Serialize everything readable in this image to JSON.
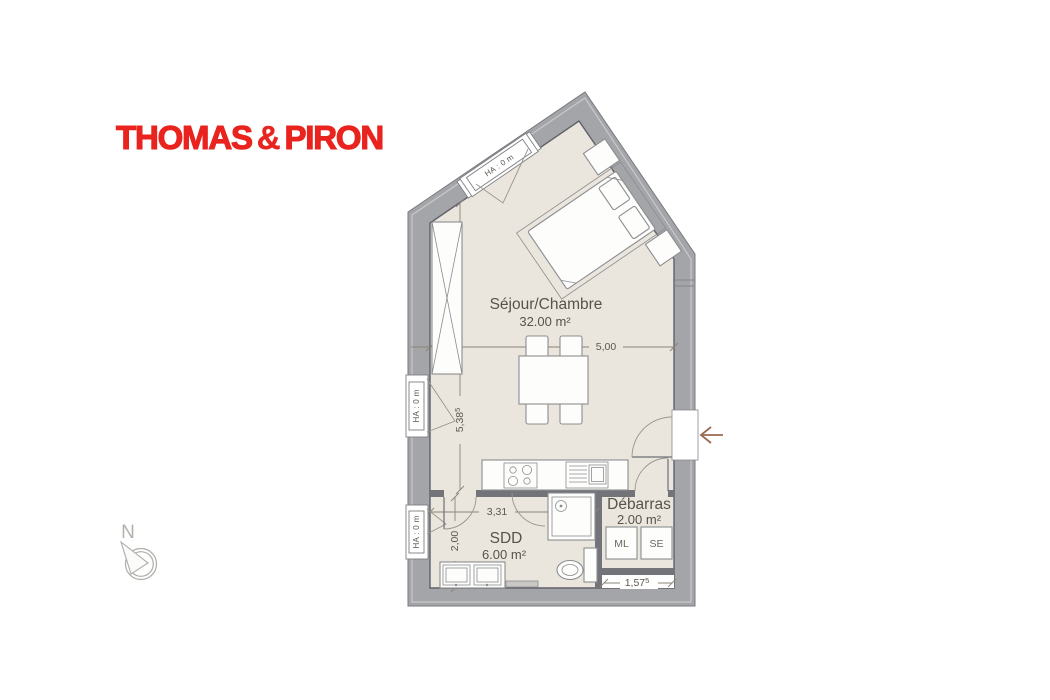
{
  "page": {
    "background": "#ffffff"
  },
  "logo": {
    "thomas": "THOMAS",
    "ampersand": "&",
    "piron": "PIRON",
    "color": "#e9231e"
  },
  "compass": {
    "north_label": "N"
  },
  "entrance": {
    "arrow_direction": "left",
    "arrow_color": "#9a6a50"
  },
  "plan": {
    "window_label": "HA : 0 m",
    "rooms": {
      "sejour": {
        "name": "Séjour/Chambre",
        "area": "32.00 m²"
      },
      "sdd": {
        "name": "SDD",
        "area": "6.00 m²"
      },
      "debarras": {
        "name": "Débarras",
        "area": "2.00 m²"
      }
    },
    "appliances": {
      "washer": "ML",
      "dryer": "SE"
    },
    "dimensions": {
      "sejour_width": "5,00",
      "sejour_height": {
        "value": "5,38",
        "sup": "5"
      },
      "sdd_width": "3,31",
      "sdd_height": "2,00",
      "niche_width": {
        "value": "1,57",
        "sup": "5"
      }
    },
    "colors": {
      "wall": "#a4a5a8",
      "interior_wall": "#73747a",
      "floor": "#eae5dd",
      "text": "#57534b",
      "dimension_line": "#8b8478"
    }
  }
}
